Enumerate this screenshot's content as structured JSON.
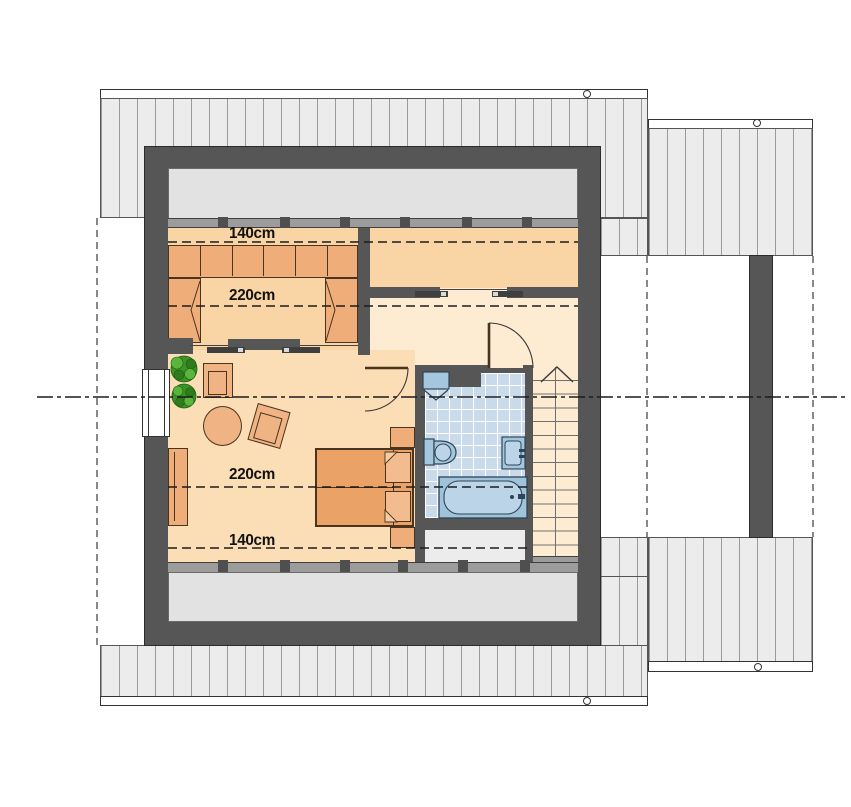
{
  "floor_plan": {
    "kind": "attic storey architectural floor plan",
    "labels": {
      "top_140": "140cm",
      "top_220": "220cm",
      "bottom_220": "220cm",
      "bottom_140": "140cm"
    },
    "rooms": [
      "bedroom",
      "room",
      "hallway",
      "living-room",
      "bathroom",
      "staircase"
    ],
    "element_icons": [
      "wardrobe-icon",
      "double-bed-icon",
      "pillow-icon",
      "armchair-icon",
      "round-table-icon",
      "chair-icon",
      "sideboard-icon",
      "plant-icon",
      "toilet-icon",
      "corner-washbasin-icon",
      "sink-icon",
      "bathtub-icon",
      "stairs-up-arrow-icon",
      "sliding-door-icon",
      "swing-door-icon",
      "window-icon",
      "chimney-icon",
      "roof-vent-icon"
    ],
    "colors": {
      "wall": "#565656",
      "roof_fill": "#ececec",
      "roof_stripe": "#9a9a9a",
      "low_zone": "#e2e2e2",
      "knee_wall": "#9c9c9c",
      "floor_warm": "#f9d4a5",
      "floor_living": "#fbddb6",
      "floor_hall": "#fdecd2",
      "furniture": "#efad79",
      "bed": "#eaa267",
      "bath_tile": "#c9dbea",
      "fixture": "#a4c7de",
      "plant": "#3c9326"
    }
  }
}
